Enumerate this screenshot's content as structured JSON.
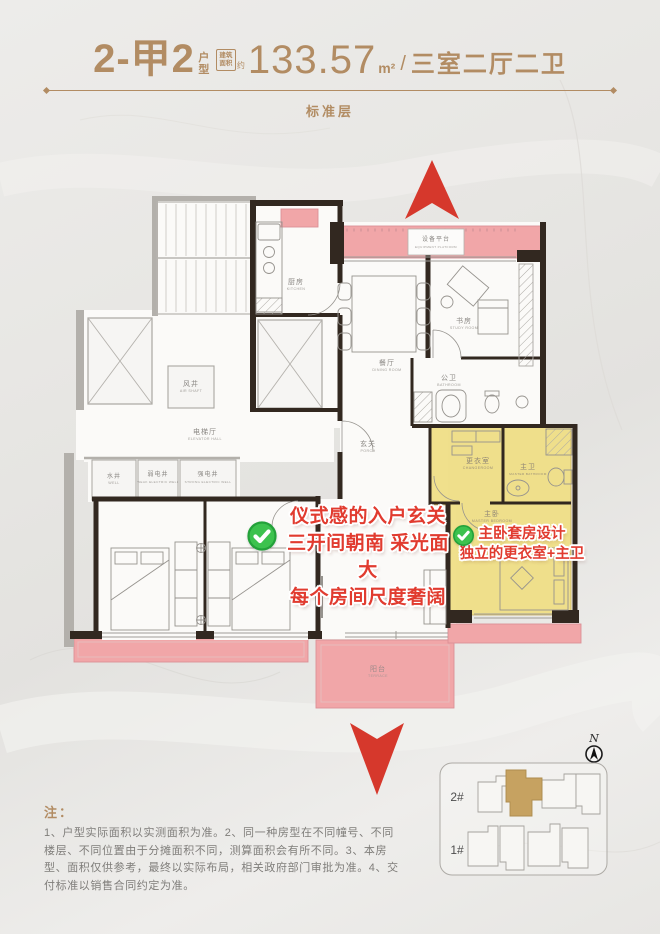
{
  "header": {
    "unit_code": "2-甲2",
    "unit_type_label": "户型",
    "area_prefix": "建筑面积",
    "area_approx": "约",
    "area_value": "133.57",
    "area_unit": "m²",
    "divider": "/",
    "room_config": "三室二厅二卫",
    "floor_label": "标准层"
  },
  "plan": {
    "rooms": {
      "kitchen": {
        "cn": "厨房",
        "en": "KITCHEN"
      },
      "equipment": {
        "cn": "设备平台",
        "en": "EQUIPMENT PLATFORM"
      },
      "dining": {
        "cn": "餐厅",
        "en": "DINING ROOM"
      },
      "study": {
        "cn": "书房",
        "en": "STUDY ROOM"
      },
      "bathroom": {
        "cn": "公卫",
        "en": "BATHROOM"
      },
      "porch": {
        "cn": "玄关",
        "en": "PORCH"
      },
      "air_shaft": {
        "cn": "风井",
        "en": "AIR SHAFT"
      },
      "elevator_hall": {
        "cn": "电梯厅",
        "en": "ELEVATOR HALL"
      },
      "well": {
        "cn": "水井",
        "en": "WELL"
      },
      "weak_well": {
        "cn": "弱电井",
        "en": "WEAK ELECTRIC WELL"
      },
      "strong_well": {
        "cn": "强电井",
        "en": "STRONG ELECTRIC WELL"
      },
      "changeroom": {
        "cn": "更衣室",
        "en": "CHANGEROOM"
      },
      "master_bath": {
        "cn": "主卫",
        "en": "MASTER BATHROOM"
      },
      "master_bedroom": {
        "cn": "主卧",
        "en": "MASTER BEDROOM"
      },
      "living": {
        "cn": "客厅",
        "en": "LIVING ROOM"
      },
      "terrace": {
        "cn": "阳台",
        "en": "TERRACE"
      }
    }
  },
  "annotations": {
    "left": {
      "line1": "仪式感的入户玄关",
      "line2": "三开间朝南 采光面大",
      "line3": "每个房间尺度奢阔"
    },
    "right": {
      "line1": "主卧套房设计",
      "line2": "独立的更衣室+主卫"
    }
  },
  "notes": {
    "label": "注：",
    "line1": "1、户型实际面积以实测面积为准。2、同一种房型在不同幢号、不同",
    "line2": "楼层、不同位置由于分摊面积不同，测算面积会有所不同。3、本房",
    "line3": "型、面积仅供参考，最终以实际布局，相关政府部门审批为准。4、交",
    "line4": "付标准以销售合同约定为准。"
  },
  "compass": {
    "label": "N"
  },
  "siteplan": {
    "building_top": "2#",
    "building_bottom": "1#"
  },
  "colors": {
    "accent_gold": "#b28c63",
    "highlight_pink": "#f1a6a8",
    "highlight_yellow": "#efde86",
    "annotation_red": "#e13b2f",
    "check_green": "#3cc24e",
    "wall_dark": "#322820",
    "site_highlight_gold": "#c6a261"
  }
}
